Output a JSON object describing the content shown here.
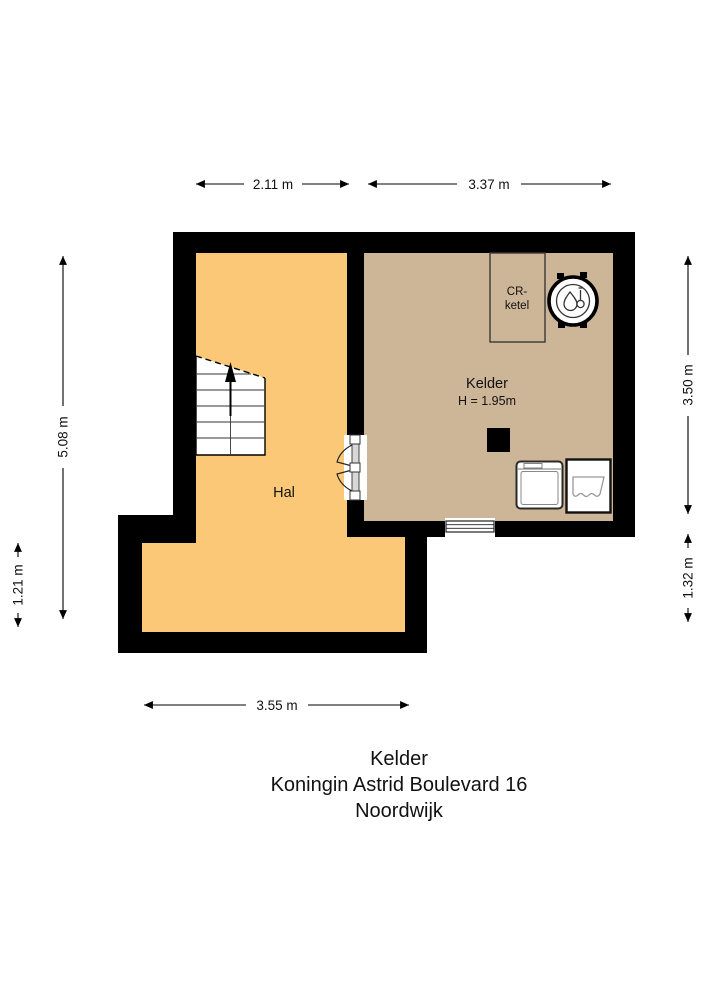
{
  "page": {
    "title_line1": "Kelder",
    "title_line2": "Koningin Astrid Boulevard 16",
    "title_line3": "Noordwijk"
  },
  "rooms": {
    "hal": {
      "label": "Hal"
    },
    "kelder": {
      "label": "Kelder",
      "ceiling_height": "H = 1.95m"
    }
  },
  "fixtures": {
    "boiler_box_line1": "CR-",
    "boiler_box_line2": "ketel"
  },
  "dimensions": {
    "top_hal_width": "2.11 m",
    "top_kelder_width": "3.37 m",
    "left_total_height": "5.08 m",
    "left_extension_height": "1.21 m",
    "right_kelder_height": "3.50 m",
    "right_lower_height": "1.32 m",
    "bottom_hal_width": "3.55 m"
  },
  "colors": {
    "hal_floor": "#FBC877",
    "kelder_floor": "#CDB598",
    "wall": "#000000"
  }
}
